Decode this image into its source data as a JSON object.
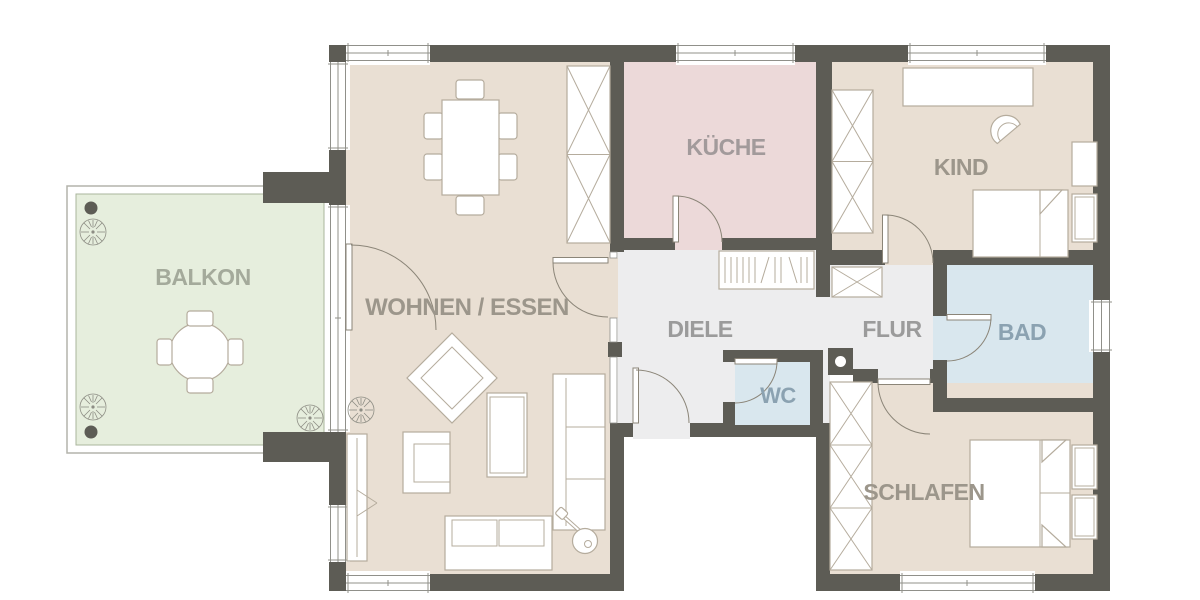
{
  "plan_title": "Apartment floor plan",
  "rooms": [
    {
      "id": "balkon",
      "label": "BALKON"
    },
    {
      "id": "wohnen",
      "label": "WOHNEN / ESSEN"
    },
    {
      "id": "kueche",
      "label": "KÜCHE"
    },
    {
      "id": "kind",
      "label": "KIND"
    },
    {
      "id": "diele",
      "label": "DIELE"
    },
    {
      "id": "flur",
      "label": "FLUR"
    },
    {
      "id": "wc",
      "label": "WC"
    },
    {
      "id": "bad",
      "label": "BAD"
    },
    {
      "id": "schlafen",
      "label": "SCHLAFEN"
    }
  ],
  "palette": {
    "wall": "#5d5c55",
    "floor_living": "#e9dfd3",
    "floor_kitchen": "#ecd9d9",
    "floor_hall": "#ededee",
    "floor_bath": "#d9e7ee",
    "floor_balcony": "#e6eedd",
    "furniture_fill": "#ffffff",
    "furniture_stroke": "#b5ac9d",
    "window_line": "#90908a",
    "door_stroke": "#8b8578",
    "label_living": "#9c968b",
    "label_kitchen": "#a29a9b",
    "label_hall": "#9b9b9b",
    "label_bath": "#8ba2b1",
    "label_balcony": "#a4aa9b"
  }
}
